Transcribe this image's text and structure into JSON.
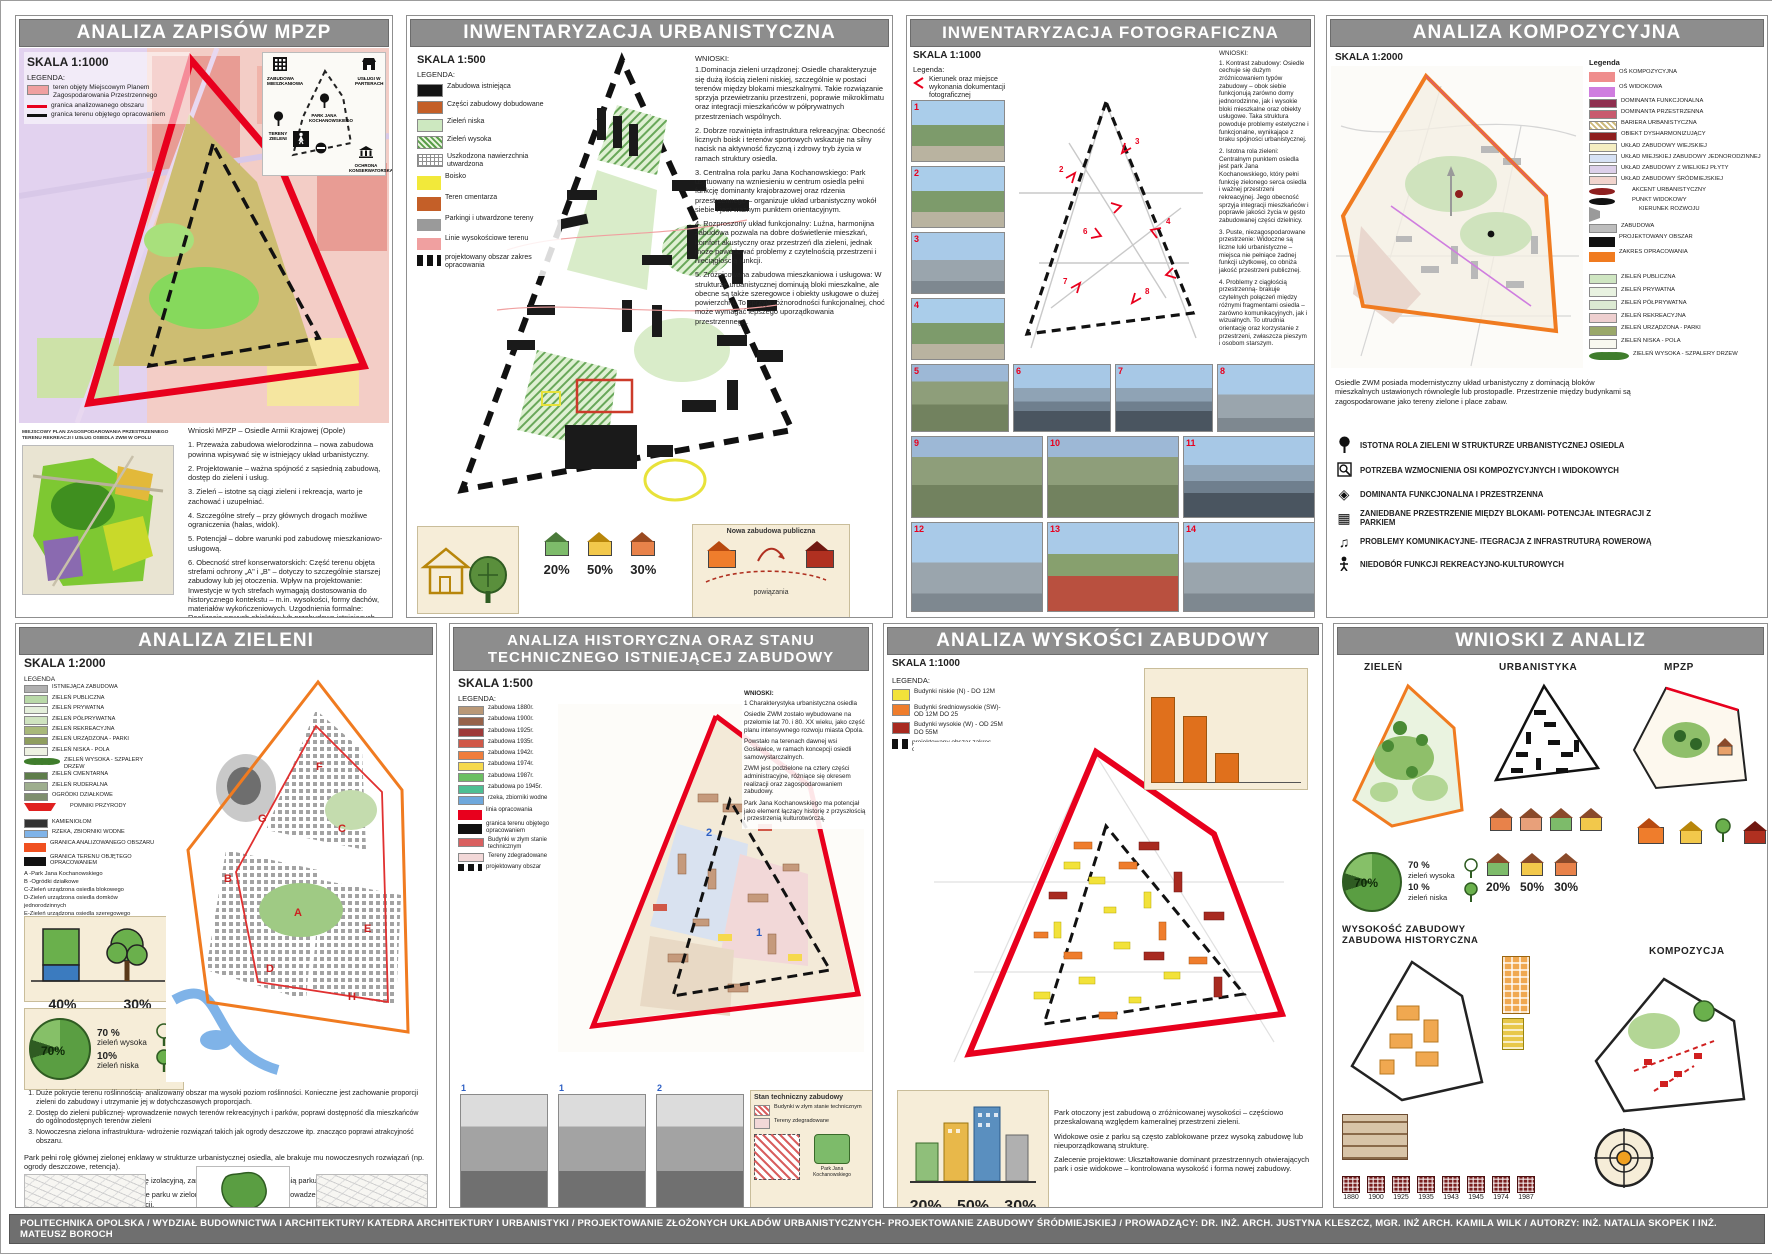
{
  "footer": {
    "text": "POLITECHNIKA OPOLSKA / WYDZIAŁ BUDOWNICTWA I ARCHITEKTURY/ KATEDRA ARCHITEKTURY I URBANISTYKI / PROJEKTOWANIE ZŁOŻONYCH UKŁADÓW URBANISTYCZNYCH- PROJEKTOWANIE ZABUDOWY ŚRÓDMIEJSKIEJ / PROWADZĄCY: DR. INŻ. ARCH. JUSTYNA KLESZCZ, MGR. INŻ ARCH. KAMILA WILK   / AUTORZY: INŻ. NATALIA SKOPEK I INŻ. MATEUSZ BOROCH"
  },
  "mpzp": {
    "title": "ANALIZA ZAPISÓW MPZP",
    "skala": "SKALA 1:1000",
    "legenda_label": "LEGENDA:",
    "legend": [
      {
        "label": "teren objęty Miejscowym Planem Zagospodarowania Przestrzennego",
        "color": "#f0a0a0",
        "cls": "sw-box"
      },
      {
        "label": "granica analizowanego obszaru",
        "color": "#e8001d",
        "cls": "sw-line"
      },
      {
        "label": "granica terenu objętego opracowaniem",
        "color": "#111111",
        "cls": "sw-dash"
      }
    ],
    "diagram": {
      "items": [
        "ZABUDOWA MIESZKANIOWA",
        "USŁUGI W PARTERACH",
        "PARK JANA KOCHANOWSKIEGO",
        "TERENY ZIELENI",
        "OCHRONA KONSERWATORSKA"
      ]
    },
    "minimap_caption": "MIEJSCOWY PLAN ZAGOSPODAROWANIA PRZESTRZENNEGO TERENU REKREACJI I USŁUG OSIEDLA ZWM W OPOLU",
    "wnioski_title": "Wnioski MPZP – Osiedle Armii Krajowej (Opole)",
    "wnioski": [
      "1. Przeważa zabudowa wielorodzinna – nowa zabudowa powinna wpisywać się w istniejący układ urbanistyczny.",
      "2. Projektowanie – ważna spójność z sąsiednią zabudową, dostęp do zieleni i usług.",
      "3. Zieleń – istotne są ciągi zieleni i rekreacja, warto je zachować i uzupełniać.",
      "4. Szczególne strefy – przy głównych drogach możliwe ograniczenia (hałas, widok).",
      "5. Potencjał – dobre warunki pod zabudowę mieszkaniowo-usługową.",
      "6. Obecność stref konserwatorskich: Część terenu objęta strefami ochrony „A\" i „B\" – dotyczy to szczególnie starszej zabudowy lub jej otoczenia. Wpływ na projektowanie: Inwestycje w tych strefach wymagają dostosowania do historycznego kontekstu – m.in. wysokości, formy dachów, materiałów wykończeniowych. Uzgodnienia formalne: Realizacja nowych obiektów lub przebudowa istniejących może wymagać uzgodnienia z konserwatorem zabytków.",
      "7. Zachowanie wartości kulturowych: Plan kładzie nacisk na ochronę układu urbanistycznego i charakterystycznych elementów architektury."
    ]
  },
  "inw_urb": {
    "title": "INWENTARYZACJA URBANISTYCZNA",
    "skala": "SKALA 1:500",
    "legenda_label": "LEGENDA:",
    "legend": [
      {
        "label": "Zabudowa istniejąca",
        "color": "#141414",
        "cls": "sw-box"
      },
      {
        "label": "Części zabudowy dobudowane",
        "color": "#c45f28",
        "cls": "sw-box"
      },
      {
        "label": "Zieleń niska",
        "color": "#cde8c0",
        "cls": "sw-box"
      },
      {
        "label": "Zieleń wysoka",
        "color": "#5a9e4a",
        "cls": "sw-hatchg"
      },
      {
        "label": "Uszkodzona nawierzchnia utwardzona",
        "color": "#909090",
        "cls": "sw-grid"
      },
      {
        "label": "Boisko",
        "color": "#f2e93a",
        "cls": "sw-line"
      },
      {
        "label": "Teren cmentarza",
        "color": "#c45f28",
        "cls": "sw-line"
      },
      {
        "label": "Parkingi i utwardzone tereny",
        "color": "#9a9a9a",
        "cls": "sw-thin"
      },
      {
        "label": "Linie wysokościowe terenu",
        "color": "#f0a0a0",
        "cls": "sw-thin"
      },
      {
        "label": "projektowany obszar zakres opracowania",
        "color": "#111111",
        "cls": "sw-dashbold"
      }
    ],
    "wnioski_label": "WNIOSKI:",
    "wnioski": [
      "1.Dominacja zieleni urządzonej: Osiedle charakteryzuje się dużą ilością zieleni niskiej, szczególnie w postaci terenów między blokami mieszkalnymi. Takie rozwiązanie sprzyja przewietrzaniu przestrzeni, poprawie mikroklimatu oraz integracji mieszkańców w półprywatnych przestrzeniach wspólnych.",
      "2. Dobrze rozwinięta infrastruktura rekreacyjna: Obecność licznych boisk i terenów sportowych wskazuje na silny nacisk na aktywność fizyczną i zdrowy tryb życia w ramach struktury osiedla.",
      "3. Centralna rola parku Jana Kochanowskiego: Park usytuowany na wzniesieniu w centrum osiedla pełni funkcję dominanty krajobrazowej oraz rdzenia przestrzennego – organizuje układ urbanistyczny wokół siebie i jest ważnym punktem orientacyjnym.",
      "4. Rozproszony układ funkcjonalny: Luźna, harmonijna zabudowa pozwala na dobre doświetlenie mieszkań, komfort akustyczny oraz przestrzeń dla zieleni, jednak może powodować problemy z czytelnością przestrzeni i nieciągłością funkcji.",
      "5. Zróżnicowana zabudowa mieszkaniowa i usługowa: W strukturze urbanistycznej dominują bloki mieszkalne, ale obecne są także szeregowce i obiekty usługowe o dużej powierzchni. To sprzyja różnorodności funkcjonalnej, choć może wymagać lepszego uporządkowania przestrzennego."
    ],
    "percents": [
      "20%",
      "50%",
      "30%"
    ],
    "card3_top": "Nowa zabudowa publiczna",
    "card3_bottom": "powiązania"
  },
  "inw_foto": {
    "title": "INWENTARYZACJA FOTOGRAFICZNA",
    "skala": "SKALA 1:1000",
    "legenda_label": "Legenda:",
    "legend_arrow_label": "Kierunek oraz miejsce wykonania dokumentacji fotograficznej",
    "wnioski_label": "WNIOSKI:",
    "wnioski": [
      "1. Kontrast zabudowy: Osiedle cechuje się dużym zróżnicowaniem typów zabudowy – obok siebie funkcjonują zarówno domy jednorodzinne, jak i wysokie bloki mieszkalne oraz obiekty usługowe. Taka struktura powoduje problemy estetyczne i funkcjonalne, wynikające z braku spójności urbanistycznej.",
      "2. Istotna rola zieleni: Centralnym punktem osiedla jest park Jana Kochanowskiego, który pełni funkcję zielonego serca osiedla i ważnej przestrzeni rekreacyjnej. Jego obecność sprzyja integracji mieszkańców i poprawie jakości życia w gęsto zabudowanej części dzielnicy.",
      "3. Puste, niezagospodarowane przestrzenie: Widoczne są liczne luki urbanistyczne – miejsca nie pełniące żadnej funkcji użytkowej, co obniża jakość przestrzeni publicznej.",
      "4. Problemy z ciągłością przestrzenną- brakuje czytelnych połączeń między różnymi fragmentami osiedla – zarówno komunikacyjnych, jak i wizualnych. To utrudnia orientację oraz korzystanie z przestrzeni, zwłaszcza pieszym i osobom starszym."
    ],
    "photos_col": [
      {
        "n": "1",
        "t": "t-a"
      },
      {
        "n": "2",
        "t": "t-a"
      },
      {
        "n": "3",
        "t": "t-d"
      },
      {
        "n": "4",
        "t": "t-a"
      }
    ],
    "row1": [
      {
        "n": "5",
        "t": "t-c"
      },
      {
        "n": "6",
        "t": "t-b"
      },
      {
        "n": "7",
        "t": "t-b"
      },
      {
        "n": "8",
        "t": "t-d"
      }
    ],
    "row2": [
      {
        "n": "9",
        "t": "t-c"
      },
      {
        "n": "10",
        "t": "t-c"
      },
      {
        "n": "11",
        "t": "t-b"
      }
    ],
    "row3": [
      {
        "n": "12",
        "t": "t-d"
      },
      {
        "n": "13",
        "t": "t-e"
      },
      {
        "n": "14",
        "t": "t-d"
      }
    ]
  },
  "kompozycja": {
    "title": "ANALIZA KOMPOZYCYJNA",
    "skala": "SKALA 1:2000",
    "legenda_label": "Legenda",
    "legend": [
      {
        "label": "OŚ KOMPOZYCYJNA",
        "color": "#ef8d8d",
        "cls": "sw-line"
      },
      {
        "label": "OŚ WIDOKOWA",
        "color": "#cf7ddf",
        "cls": "sw-line"
      },
      {
        "label": "DOMINANTA FUNKCJONALNA",
        "color": "#8e2f4f",
        "cls": "sw-box"
      },
      {
        "label": "DOMINANTA PRZESTRZENNA",
        "color": "#c85a6e",
        "cls": "sw-box"
      },
      {
        "label": "BARIERA URBANISTYCZNA",
        "color": "#cdb97a",
        "cls": "sw-hatch"
      },
      {
        "label": "OBIEKT DYSHARMONIZUJĄCY",
        "color": "#8e1f1f",
        "cls": "sw-box"
      },
      {
        "label": "UKŁAD ZABUDOWY WIEJSKIEJ",
        "color": "#f5eec2",
        "cls": "sw-box"
      },
      {
        "label": "UKŁAD MIEJSKIEJ ZABUDOWY JEDNORODZINNEJ",
        "color": "#d7e2f5",
        "cls": "sw-box"
      },
      {
        "label": "UKŁAD ZABUDOWY Z WIELKIEJ PŁYTY",
        "color": "#ddd0ea",
        "cls": "sw-box"
      },
      {
        "label": "UKŁAD ZABUDOWY ŚRÓDMIEJSKIEJ",
        "color": "#f2d4cd",
        "cls": "sw-box"
      },
      {
        "label": "AKCENT URBANISTYCZNY",
        "color": "#8e1f1f",
        "cls": "sw-dot"
      },
      {
        "label": "PUNKT WIDOKOWY",
        "color": "#111111",
        "cls": "sw-dot"
      },
      {
        "label": "KIERUNEK ROZWOJU",
        "color": "#9a9a9a",
        "cls": "sw-arrow"
      },
      {
        "label": "ZABUDOWA",
        "color": "#bdbdbd",
        "cls": "sw-box"
      },
      {
        "label": "PROJEKTOWANY OBSZAR",
        "color": "#111111",
        "cls": "sw-dash"
      },
      {
        "label": "ZAKRES OPRACOWANIA",
        "color": "#f07b20",
        "cls": "sw-line"
      }
    ],
    "green_legend": [
      {
        "label": "ZIELEŃ PUBLICZNA",
        "color": "#cfe6c2",
        "cls": "sw-box"
      },
      {
        "label": "ZIELEŃ PRYWATNA",
        "color": "#e8f2e0",
        "cls": "sw-box"
      },
      {
        "label": "ZIELEŃ PÓŁPRYWATNA",
        "color": "#dcead2",
        "cls": "sw-box"
      },
      {
        "label": "ZIELEŃ REKREACYJNA",
        "color": "#eecfcf",
        "cls": "sw-box"
      },
      {
        "label": "ZIELEŃ URZĄDZONA - PARKI",
        "color": "#9aa86a",
        "cls": "sw-box"
      },
      {
        "label": "ZIELEŃ NISKA - POLA",
        "color": "#f8f8ef",
        "cls": "sw-box"
      },
      {
        "label": "ZIELEŃ WYSOKA - SZPALERY DRZEW",
        "color": "#3f7d2c",
        "cls": "sw-dots3"
      }
    ],
    "paragraph": "Osiedle ZWM posiada modernistyczny układ urbanistyczny z dominacją bloków mieszkalnych ustawionych równolegle lub prostopadle. Przestrzenie między budynkami są zagospodarowane jako tereny zielone i place zabaw.",
    "conclusions": [
      "ISTOTNA ROLA ZIELENI W STRUKTURZE URBANISTYCZNEJ OSIEDLA",
      "POTRZEBA WZMOCNIENIA OSI KOMPOZYCYJNYCH I WIDOKOWYCH",
      "DOMINANTA FUNKCJONALNA I PRZESTRZENNA",
      "ZANIEDBANE PRZESTRZENIE MIĘDZY BLOKAMI- POTENCJAŁ INTEGRACJI Z PARKIEM",
      "PROBLEMY KOMUNIKACYJNE- ITEGRACJA Z INFRASTRUTURĄ ROWEROWĄ",
      "NIEDOBÓR FUNKCJI REKREACYJNO-KULTUROWYCH"
    ]
  },
  "zielen": {
    "title": "ANALIZA ZIELENI",
    "skala": "SKALA 1:2000",
    "legenda_label": "LEGENDA",
    "legend": [
      {
        "label": "ISTNIEJĄCA ZABUDOWA",
        "color": "#b0b0b0",
        "cls": "sw-box"
      },
      {
        "label": "ZIELEŃ PUBLICZNA",
        "color": "#b9d9a8",
        "cls": "sw-box"
      },
      {
        "label": "ZIELEŃ PRYWATNA",
        "color": "#e4efdb",
        "cls": "sw-box"
      },
      {
        "label": "ZIELEŃ PÓŁPRYWATNA",
        "color": "#cfe3c0",
        "cls": "sw-box"
      },
      {
        "label": "ZIELEŃ REKREACYJNA",
        "color": "#a8b87a",
        "cls": "sw-box"
      },
      {
        "label": "ZIELEŃ URZĄDZONA - PARKI",
        "color": "#8f9e5e",
        "cls": "sw-box"
      },
      {
        "label": "ZIELEŃ NISKA - POLA",
        "color": "#eef2e2",
        "cls": "sw-box"
      },
      {
        "label": "ZIELEŃ WYSOKA - SZPALERY DRZEW",
        "color": "#3f7d2c",
        "cls": "sw-dots3"
      },
      {
        "label": "ZIELEŃ CMENTARNA",
        "color": "#5e7d4a",
        "cls": "sw-box"
      },
      {
        "label": "ZIELEŃ RUDERALNA",
        "color": "#9eae8e",
        "cls": "sw-box"
      },
      {
        "label": "OGRÓDKI DZIAŁKOWE",
        "color": "#7e8e6e",
        "cls": "sw-box"
      },
      {
        "label": "POMNIKI PRZYRODY",
        "color": "#e02020",
        "cls": "sw-tri"
      },
      {
        "label": "KAMIENIOŁOM",
        "color": "#333333",
        "cls": "sw-box"
      },
      {
        "label": "RZEKA, ZBIORNIKI WODNE",
        "color": "#7fb3e8",
        "cls": "sw-box"
      },
      {
        "label": "GRANICA ANALIZOWANEGO OBSZARU",
        "color": "#f05020",
        "cls": "sw-line"
      },
      {
        "label": "GRANICA TERENU OBJĘTEGO OPRACOWANIEM",
        "color": "#111111",
        "cls": "sw-dash"
      }
    ],
    "letters": [
      "A -Park Jana Kochanowskiego",
      "B -Ogródki działkowe",
      "C-Zieleń urządzona osiedla blokowego",
      "D-Zieleń urządzona osiedla domków jednorodzinnych",
      "E-Zieleń urządzona osiedla szeregowego",
      "F-zieleń publiczna",
      "G-plac Politechniki Opolskiej",
      "H-skwer",
      "W. Sikorskiego"
    ],
    "bar_pct": "40%",
    "tree_pct": "30%",
    "pie_pct": "70%",
    "pie_high_pct": "70 %",
    "pie_high_label": "zieleń wysoka",
    "pie_low_pct": "10%",
    "pie_low_label": "zieleń niska",
    "conclusions": [
      "Duże pokrycie terenu roślinnością- analizowany obszar ma wysoki poziom roślinności. Konieczne jest zachowanie proporcji zieleni do zabudowy i utrzymanie jej w dotychczasowych proporcjach.",
      "Dostęp do zieleni publicznej- wprowadzenie nowych terenów rekreacyjnych i parków,  poprawi dostępność dla mieszkańców do ogólnodostępnych terenów zieleni",
      "Nowoczesna zielona infrastruktura- wdrożenie rozwiązań takich jak ogrody deszczowe itp. znacząco poprawi atrakcyjność obszaru."
    ],
    "paragraphs": [
      "Park pełni rolę głównej zielonej enklawy w strukturze urbanistycznej osiedla, ale brakuje mu nowoczesnych rozwiązań (np. ogrody deszczowe, retencja).",
      "Otaczająca zieleń często pełni funkcję izolacyjną, zamiast współgrać z przestrzenią parku.",
      "Zalecenie projektowe: Przekształcenie parku w zielone centrum aktywności – wprowadzenie ekologicznych rozwiązań, placów spotkań, stref relaksu i edukacji."
    ],
    "park_label": "Park Jana Kochanowskiego"
  },
  "historia": {
    "title": "ANALIZA HISTORYCZNA ORAZ STANU TECHNICZNEGO ISTNIEJĄCEJ ZABUDOWY",
    "skala": "SKALA 1:500",
    "legenda_label": "LEGENDA:",
    "legend": [
      {
        "label": "zabudowa 1880r.",
        "color": "#b99877",
        "cls": "sw-box"
      },
      {
        "label": "zabudowa 1900r.",
        "color": "#96624a",
        "cls": "sw-box"
      },
      {
        "label": "zabudowa 1925r.",
        "color": "#9e3a3a",
        "cls": "sw-box"
      },
      {
        "label": "zabudowa 1935r.",
        "color": "#d05848",
        "cls": "sw-box"
      },
      {
        "label": "zabudowa 1942r.",
        "color": "#ef7d3c",
        "cls": "sw-box"
      },
      {
        "label": "zabudowa 1974r.",
        "color": "#f6d94d",
        "cls": "sw-box"
      },
      {
        "label": "zabudowa 1987r.",
        "color": "#6cbf63",
        "cls": "sw-box"
      },
      {
        "label": "zabudowa po 1945r.",
        "color": "#4dbf93",
        "cls": "sw-box"
      },
      {
        "label": "rzeka, zbiorniki wodne",
        "color": "#6fa8dc",
        "cls": "sw-box"
      },
      {
        "label": "linia opracowania",
        "color": "#e8001d",
        "cls": "sw-line"
      },
      {
        "label": "granica terenu objętego opracowaniem",
        "color": "#111111",
        "cls": "sw-dash"
      },
      {
        "label": "Budynki w złym stanie technicznym",
        "color": "#d96060",
        "cls": "sw-box"
      },
      {
        "label": "Tereny zdegradowane",
        "color": "#f2d8d8",
        "cls": "sw-box"
      },
      {
        "label": "projektowany obszar",
        "color": "#111111",
        "cls": "sw-dashbold"
      }
    ],
    "wnioski_label": "WNIOSKI:",
    "wnioski_sub": "1 Charakterystyka urbanistyczna osiedla",
    "wnioski": [
      "Osiedle ZWM zostało wybudowane na przełomie lat 70. i 80. XX wieku, jako część planu intensywnego rozwoju miasta Opola.",
      "Powstało na terenach dawnej wsi Gosławice, w ramach koncepcji osiedli samowystarczalnych.",
      "ZWM jest podzielone na cztery części administracyjne, różniące się okresem realizacji oraz zagospodarowaniem zabudowy.",
      "Park Jana Kochanowskiego ma potencjał jako element łączący historię z przyszłością i przestrzenią kulturotwórczą."
    ],
    "photos": [
      {
        "n": "1",
        "t": "t-bw"
      },
      {
        "n": "1",
        "t": "t-bw"
      },
      {
        "n": "2",
        "t": "t-bw"
      }
    ],
    "stan_title": "Stan techniczny zabudowy",
    "stan_items": [
      {
        "label": "Budynki w złym stanie technicznym",
        "color": "#d96060",
        "cls": "sw-hatch"
      },
      {
        "label": "Tereny zdegradowane",
        "color": "#f2d8d8",
        "cls": "sw-box"
      }
    ],
    "stan_park_label": "Park Jana Kochanowskiego"
  },
  "wysokosc": {
    "title": "ANALIZA WYSKOŚCI ZABUDOWY",
    "skala": "SKALA 1:1000",
    "legenda_label": "LEGENDA:",
    "legend": [
      {
        "label": "Budynki niskie (N) - DO 12M",
        "color": "#f2e23a",
        "cls": "sw-box"
      },
      {
        "label": "Budynki średniowysokie (SW)- OD 12M DO 25",
        "color": "#ef7d2c",
        "cls": "sw-box"
      },
      {
        "label": "Budynki wysokie (W) - OD 25M DO 55M",
        "color": "#a82a20",
        "cls": "sw-box"
      },
      {
        "label": "projektowany obszar zakres opracowania",
        "color": "#111111",
        "cls": "sw-dashbold"
      }
    ],
    "bars": [
      {
        "h": "78%",
        "c": "#e0701c"
      },
      {
        "h": "60%",
        "c": "#ef9335"
      },
      {
        "h": "26%",
        "c": "#f3b066"
      }
    ],
    "percents": [
      "20%",
      "50%",
      "30%"
    ],
    "notes": [
      "Park otoczony jest zabudową o zróżnicowanej wysokości – częściowo przeskalowaną względem kameralnej przestrzeni zieleni.",
      "Widokowe osie z parku są często zablokowane przez wysoką zabudowę lub nieuporządkowaną strukturę.",
      "Zalecenie projektowe: Ukształtowanie dominant przestrzennych otwierających park i osie widokowe – kontrolowana wysokość i forma nowej zabudowy."
    ]
  },
  "wnioski_analiz": {
    "title": "WNIOSKI Z ANALIZ",
    "sections": [
      "ZIELEŃ",
      "URBANISTYKA",
      "MPZP"
    ],
    "pie_pct": "70%",
    "pie_high_pct": "70 %",
    "pie_high_label": "zieleń wysoka",
    "pie_low_pct": "10 %",
    "pie_low_label": "zieleń niska",
    "houses": [
      {
        "c": "#e8824a"
      },
      {
        "c": "#e8a07a"
      },
      {
        "c": "#7dbb6a"
      },
      {
        "c": "#f2c84b"
      }
    ],
    "pct_houses": [
      {
        "c": "#7dbb6a",
        "pct": "20%"
      },
      {
        "c": "#f2c84b",
        "pct": "50%"
      },
      {
        "c": "#e8824a",
        "pct": "30%"
      }
    ],
    "label_height_1": "WYSOKOŚĆ ZABUDOWY",
    "label_height_2": "ZABUDOWA HISTORYCZNA",
    "label_komp": "KOMPOZYCJA",
    "years": [
      "1880",
      "1900",
      "1925",
      "1935",
      "1943",
      "1945",
      "1974",
      "1987"
    ]
  }
}
